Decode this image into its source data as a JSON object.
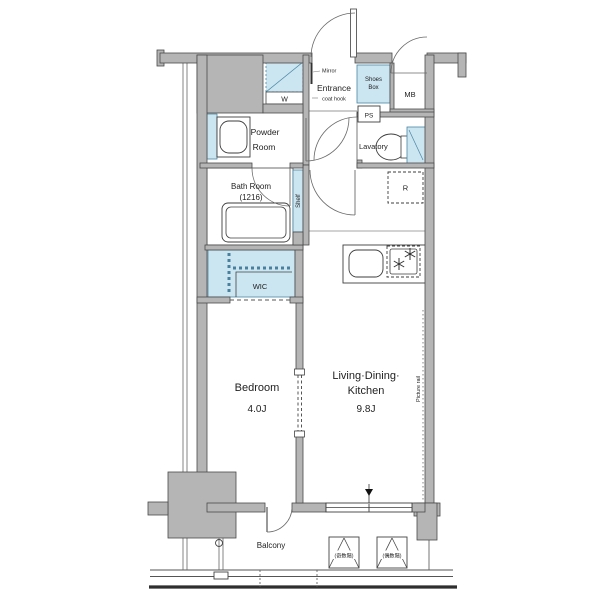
{
  "floor_plan": {
    "labels": {
      "entrance": "Entrance",
      "mirror": "Mirror",
      "coat_hook": "coat hook",
      "shoes_box_line1": "Shoes",
      "shoes_box_line2": "Box",
      "mb": "MB",
      "ps": "PS",
      "washer": "W",
      "powder_line1": "Powder",
      "powder_line2": "Room",
      "lavatory": "Lavatory",
      "bath_line1": "Bath Room",
      "bath_line2": "(1216)",
      "shelf": "Shelf",
      "refrigerator": "R",
      "wic": "WIC",
      "bedroom": "Bedroom",
      "bedroom_size": "4.0J",
      "ldk_line1": "Living·Dining·",
      "ldk_line2": "Kitchen",
      "ldk_size": "9.8J",
      "picture_rail": "Picture rail",
      "balcony": "Balcony",
      "hatch_odd": "(奇数階)",
      "hatch_even": "(偶数階)"
    },
    "colors": {
      "wall_gray": "#b5b5b5",
      "fixture_blue": "#cbe5f1",
      "line": "#3d3d3d"
    }
  }
}
